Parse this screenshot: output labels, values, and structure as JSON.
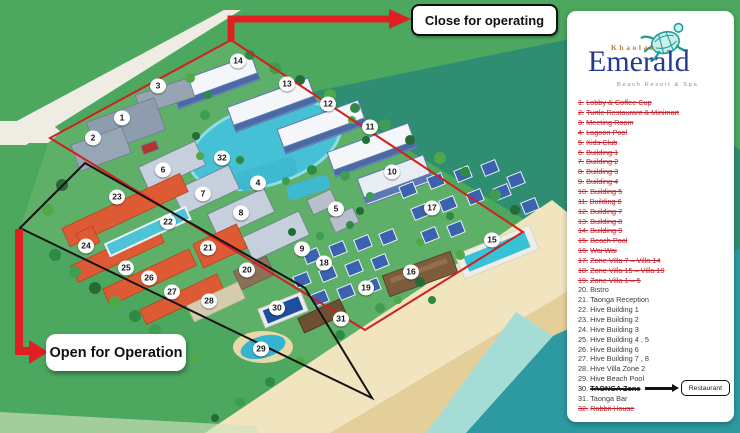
{
  "logo": {
    "brand_top": "Khaolak",
    "brand_main": "Emerald",
    "tagline": "Beach Resort & Spa"
  },
  "callouts": {
    "close_label": "Close for operating",
    "open_label": "Open for Operation"
  },
  "legend": {
    "replacement_label": "Restaurant",
    "items": [
      {
        "num": "1.",
        "label": "Lobby & Coffee Cup",
        "status": "closed"
      },
      {
        "num": "2.",
        "label": "Turtle Restaurant & Minimart",
        "status": "closed"
      },
      {
        "num": "3.",
        "label": "Meeting Room",
        "status": "closed"
      },
      {
        "num": "4.",
        "label": "Lagoon Pool",
        "status": "closed"
      },
      {
        "num": "5.",
        "label": "Kids Club",
        "status": "closed"
      },
      {
        "num": "6.",
        "label": "Building 1",
        "status": "closed"
      },
      {
        "num": "7.",
        "label": "Building 2",
        "status": "closed"
      },
      {
        "num": "8.",
        "label": "Building 3",
        "status": "closed"
      },
      {
        "num": "9.",
        "label": "Building 4",
        "status": "closed"
      },
      {
        "num": "10.",
        "label": "Building 5",
        "status": "closed"
      },
      {
        "num": "11.",
        "label": "Building 6",
        "status": "closed"
      },
      {
        "num": "12.",
        "label": "Building 7",
        "status": "closed"
      },
      {
        "num": "13.",
        "label": "Building 8",
        "status": "closed"
      },
      {
        "num": "14.",
        "label": "Building 9",
        "status": "closed"
      },
      {
        "num": "15.",
        "label": "Beach Pool",
        "status": "closed"
      },
      {
        "num": "16.",
        "label": "Wai Wai",
        "status": "closed"
      },
      {
        "num": "17.",
        "label": "Zone Villa 7 – Villa 14",
        "status": "closed"
      },
      {
        "num": "18.",
        "label": "Zone Villa 15 – Villa 19",
        "status": "closed"
      },
      {
        "num": "19.",
        "label": "Zone Villa 1 – 5",
        "status": "closed"
      },
      {
        "num": "20.",
        "label": "Bistro",
        "status": "open"
      },
      {
        "num": "21.",
        "label": "Taonga Reception",
        "status": "open"
      },
      {
        "num": "22.",
        "label": "Hive Building 1",
        "status": "open"
      },
      {
        "num": "23.",
        "label": "Hive Building 2",
        "status": "open"
      },
      {
        "num": "24.",
        "label": "Hive Building 3",
        "status": "open"
      },
      {
        "num": "25.",
        "label": "Hive Building 4 , 5",
        "status": "open"
      },
      {
        "num": "26.",
        "label": "Hive Building 6",
        "status": "open"
      },
      {
        "num": "27.",
        "label": "Hive Building 7 , 8",
        "status": "open"
      },
      {
        "num": "28.",
        "label": "Hive Villa Zone 2",
        "status": "open"
      },
      {
        "num": "29.",
        "label": "Hive Beach Pool",
        "status": "open"
      },
      {
        "num": "30.",
        "label": "TAONGA Zone",
        "status": "replaced"
      },
      {
        "num": "31.",
        "label": "Taonga Bar",
        "status": "open"
      },
      {
        "num": "32.",
        "label": "Rabbit House",
        "status": "closed"
      }
    ]
  },
  "map": {
    "markers": [
      {
        "n": "1",
        "x": 122,
        "y": 118
      },
      {
        "n": "2",
        "x": 93,
        "y": 138
      },
      {
        "n": "3",
        "x": 158,
        "y": 86
      },
      {
        "n": "4",
        "x": 258,
        "y": 183
      },
      {
        "n": "5",
        "x": 336,
        "y": 209
      },
      {
        "n": "6",
        "x": 163,
        "y": 170
      },
      {
        "n": "7",
        "x": 203,
        "y": 194
      },
      {
        "n": "8",
        "x": 241,
        "y": 213
      },
      {
        "n": "9",
        "x": 302,
        "y": 249
      },
      {
        "n": "10",
        "x": 392,
        "y": 172
      },
      {
        "n": "11",
        "x": 370,
        "y": 127
      },
      {
        "n": "12",
        "x": 328,
        "y": 104
      },
      {
        "n": "13",
        "x": 287,
        "y": 84
      },
      {
        "n": "14",
        "x": 238,
        "y": 61
      },
      {
        "n": "15",
        "x": 492,
        "y": 240
      },
      {
        "n": "16",
        "x": 411,
        "y": 272
      },
      {
        "n": "17",
        "x": 432,
        "y": 208
      },
      {
        "n": "18",
        "x": 324,
        "y": 263
      },
      {
        "n": "19",
        "x": 366,
        "y": 288
      },
      {
        "n": "20",
        "x": 247,
        "y": 270
      },
      {
        "n": "21",
        "x": 208,
        "y": 248
      },
      {
        "n": "22",
        "x": 168,
        "y": 222
      },
      {
        "n": "23",
        "x": 117,
        "y": 197
      },
      {
        "n": "24",
        "x": 86,
        "y": 246
      },
      {
        "n": "25",
        "x": 126,
        "y": 268
      },
      {
        "n": "26",
        "x": 149,
        "y": 278
      },
      {
        "n": "27",
        "x": 172,
        "y": 292
      },
      {
        "n": "28",
        "x": 209,
        "y": 301
      },
      {
        "n": "29",
        "x": 261,
        "y": 349
      },
      {
        "n": "30",
        "x": 277,
        "y": 308
      },
      {
        "n": "31",
        "x": 341,
        "y": 319
      },
      {
        "n": "32",
        "x": 222,
        "y": 158
      }
    ]
  },
  "colors": {
    "accent_red": "#e02020",
    "closed_text": "#c4232e",
    "open_text": "#3c3c3c",
    "brand_navy": "#22398f",
    "brand_teal": "#1fa096",
    "sea_teal": "#2d9aa1",
    "sand": "#eedfae",
    "grass": "#4ca75f"
  }
}
